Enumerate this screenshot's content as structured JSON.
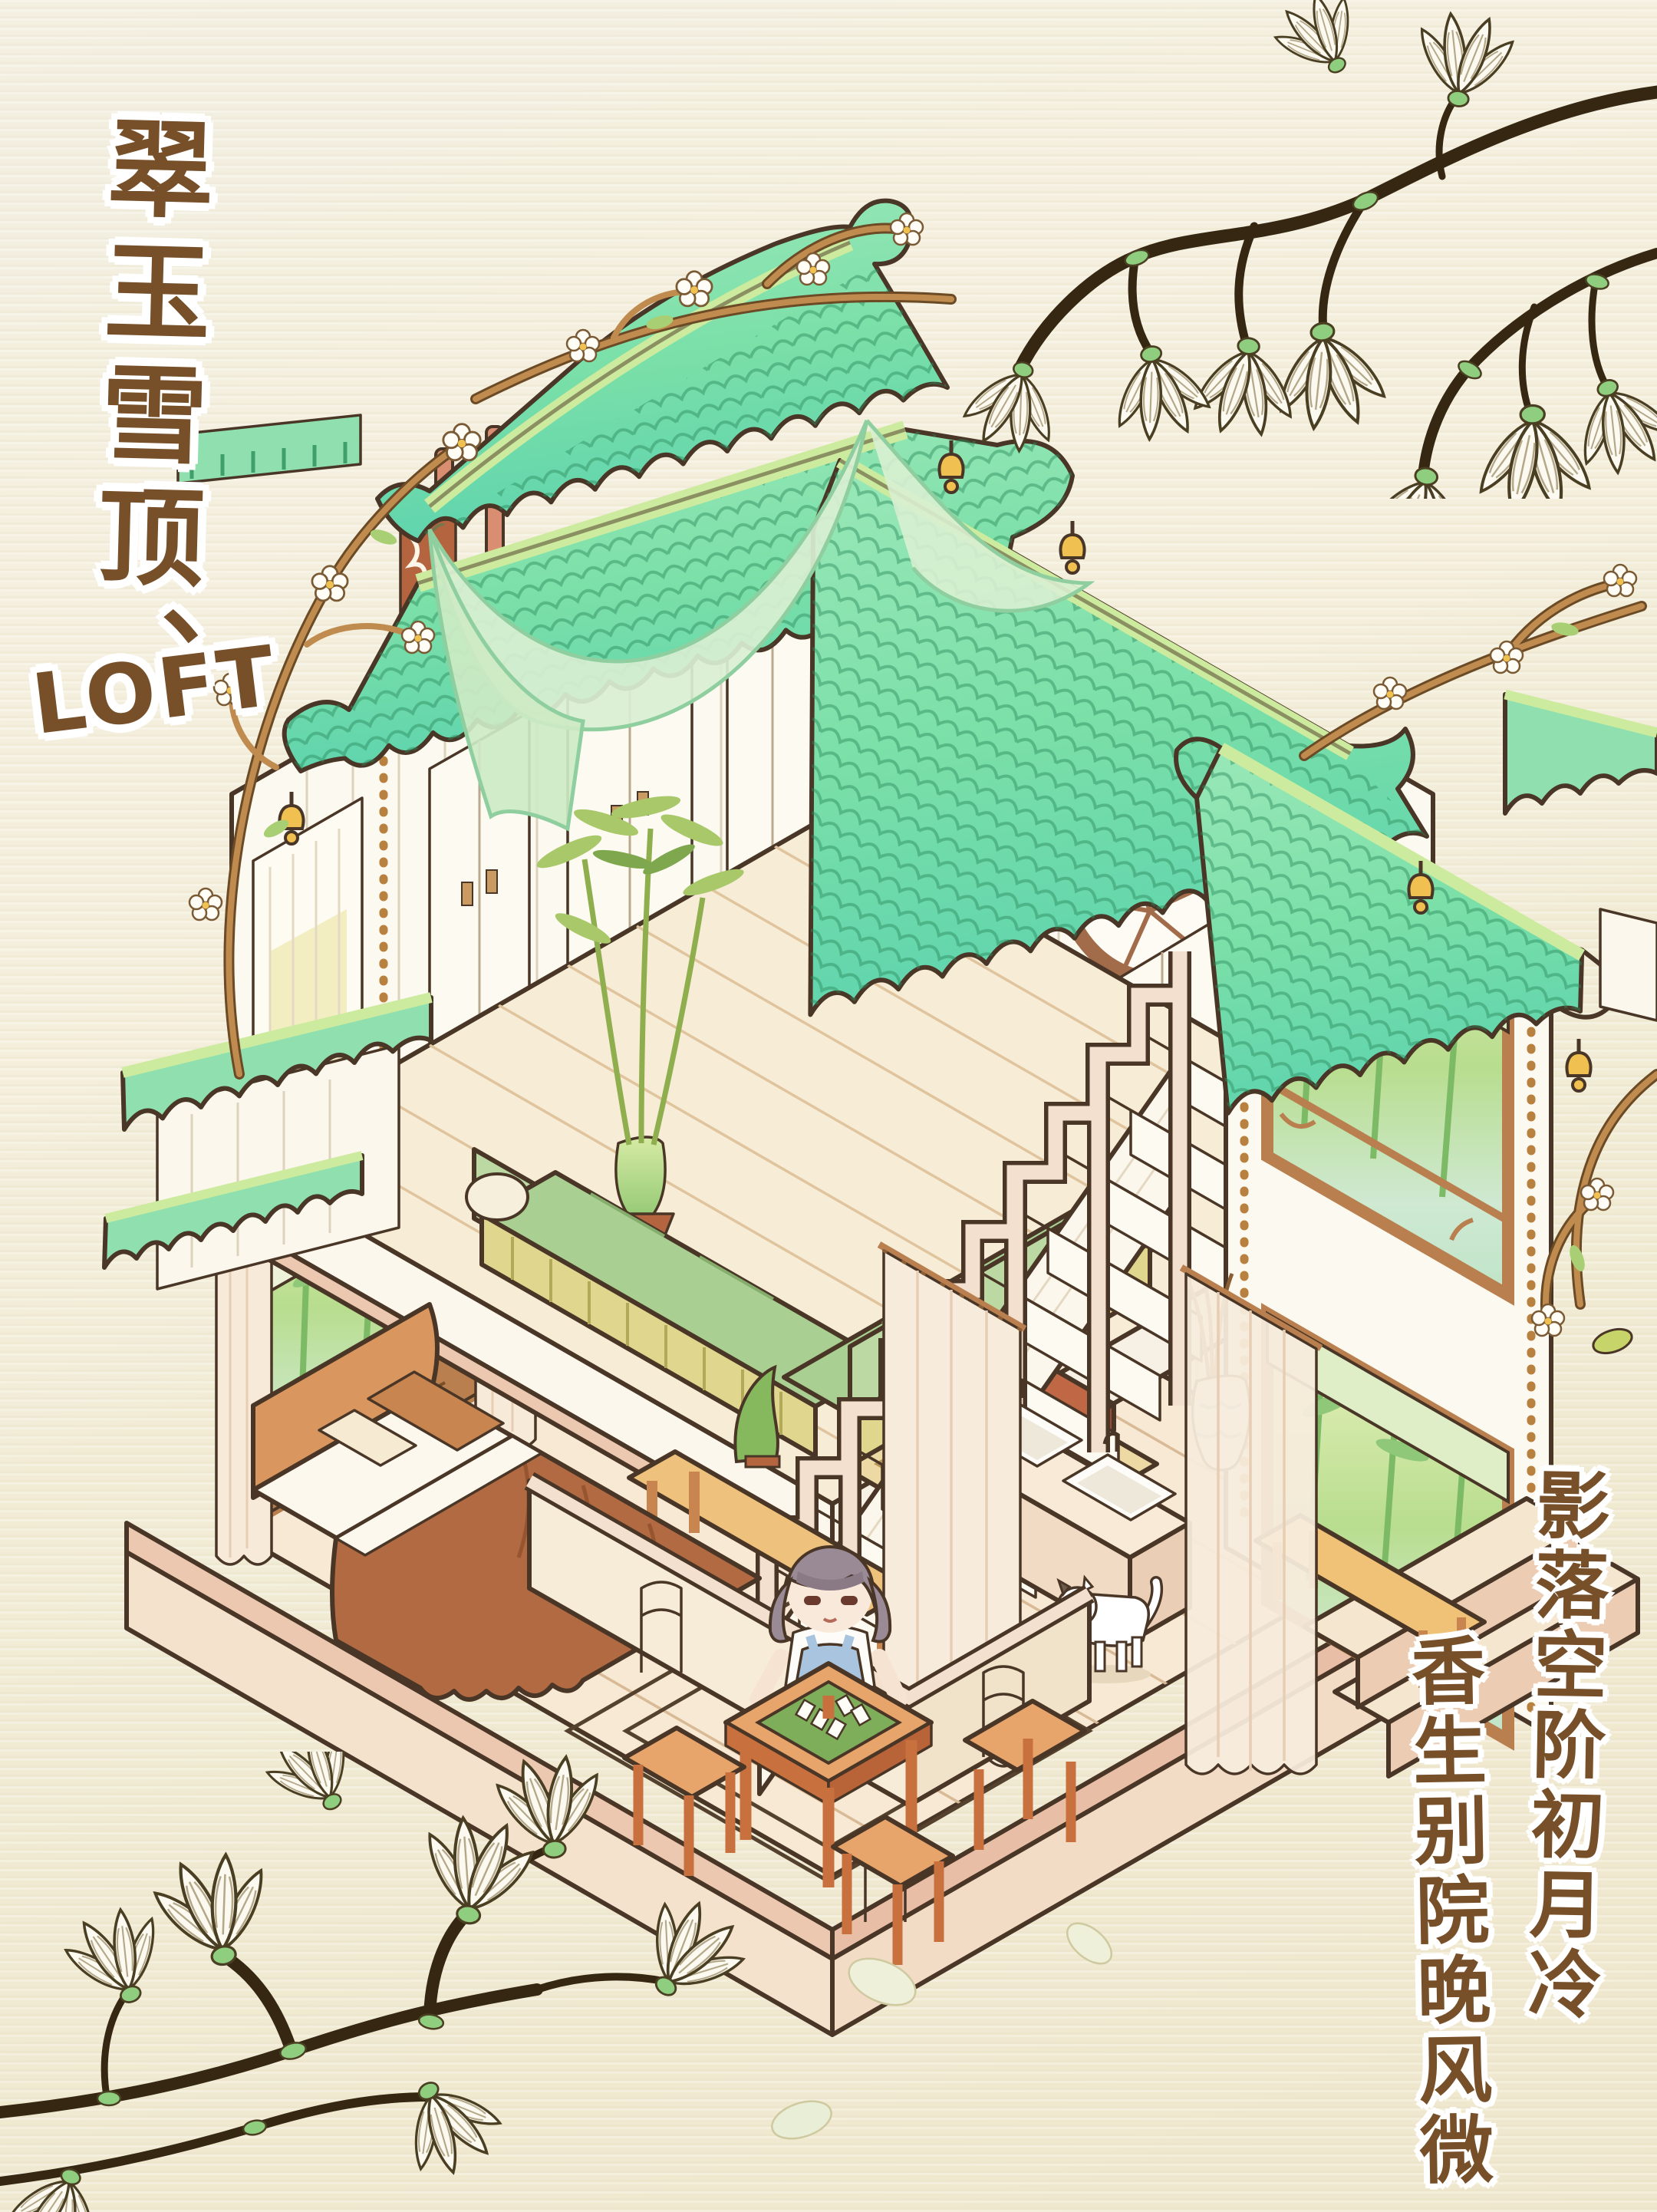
{
  "artwork": {
    "title_vertical": "翠玉雪顶、",
    "title_latin": "LOFT",
    "poem_column_right": "影落空阶初月冷",
    "poem_column_left": "香生别院晚风微"
  },
  "palette": {
    "background": "#f2eedc",
    "roof_green": "#82dfa8",
    "roof_teal": "#5fd4ae",
    "ridge_green": "#cdeb9e",
    "wood_orange": "#dd9a5e",
    "pillar_pink": "#d98e72",
    "wall_white": "#fcf9f0",
    "floor_cream": "#f6e9d2",
    "stair_cream": "#f6e3d3",
    "sofa_green": "#a9cf92",
    "table_red": "#bb5f40",
    "blanket_brown": "#b26a42",
    "bell_gold": "#f0c050",
    "branch_dark": "#3a2a14",
    "branch_orange": "#c08b4e",
    "text_brown": "#77502a"
  }
}
